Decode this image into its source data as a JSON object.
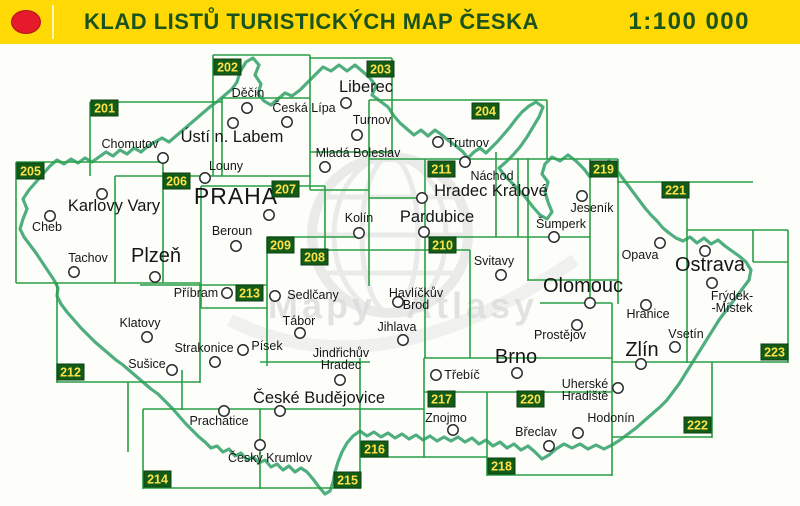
{
  "header": {
    "title": "KLAD LISTŮ TURISTICKÝCH MAP ČESKA",
    "scale": "1:100 000",
    "logo": "red-dot"
  },
  "colors": {
    "header_bg": "#ffd903",
    "header_text": "#1a531d",
    "logo_red": "#e51a2b",
    "logo_red_edge": "#b01020",
    "grid": "#28a044",
    "badge_bg": "#135c17",
    "badge_edge": "#0b3f10",
    "badge_text": "#ffe14a",
    "border": "#4fae7e",
    "city_text": "#161616",
    "marker_stroke": "#2d2d2d",
    "watermark": "#dcdcdc"
  },
  "map": {
    "watermark_words": [
      "Mapy",
      "Atlasy"
    ],
    "sheets": [
      {
        "num": "201",
        "x": 91,
        "y": 100
      },
      {
        "num": "202",
        "x": 214,
        "y": 59
      },
      {
        "num": "203",
        "x": 367,
        "y": 61
      },
      {
        "num": "204",
        "x": 472,
        "y": 103
      },
      {
        "num": "205",
        "x": 17,
        "y": 163
      },
      {
        "num": "206",
        "x": 163,
        "y": 173
      },
      {
        "num": "207",
        "x": 272,
        "y": 181
      },
      {
        "num": "208",
        "x": 301,
        "y": 249
      },
      {
        "num": "209",
        "x": 267,
        "y": 237
      },
      {
        "num": "210",
        "x": 429,
        "y": 237
      },
      {
        "num": "211",
        "x": 428,
        "y": 161
      },
      {
        "num": "212",
        "x": 57,
        "y": 364
      },
      {
        "num": "213",
        "x": 236,
        "y": 285
      },
      {
        "num": "214",
        "x": 144,
        "y": 471
      },
      {
        "num": "215",
        "x": 334,
        "y": 472
      },
      {
        "num": "216",
        "x": 361,
        "y": 441
      },
      {
        "num": "217",
        "x": 428,
        "y": 391
      },
      {
        "num": "218",
        "x": 488,
        "y": 458
      },
      {
        "num": "219",
        "x": 590,
        "y": 161
      },
      {
        "num": "220",
        "x": 517,
        "y": 391
      },
      {
        "num": "221",
        "x": 662,
        "y": 182
      },
      {
        "num": "222",
        "x": 684,
        "y": 417
      },
      {
        "num": "223",
        "x": 761,
        "y": 344
      }
    ],
    "cities": [
      {
        "n": [
          "Děčín"
        ],
        "cx": 247,
        "cy": 108,
        "lx": 248,
        "ly": 97,
        "s": "s"
      },
      {
        "n": [
          "Česká Lípa"
        ],
        "cx": 287,
        "cy": 122,
        "lx": 304,
        "ly": 112,
        "s": "s"
      },
      {
        "n": [
          "Liberec"
        ],
        "cx": 346,
        "cy": 103,
        "lx": 366,
        "ly": 92,
        "s": "m"
      },
      {
        "n": [
          "Turnov"
        ],
        "cx": 357,
        "cy": 135,
        "lx": 372,
        "ly": 124,
        "s": "s"
      },
      {
        "n": [
          "Mladá Boleslav"
        ],
        "cx": 325,
        "cy": 167,
        "lx": 358,
        "ly": 157,
        "s": "s"
      },
      {
        "n": [
          "Trutnov"
        ],
        "cx": 438,
        "cy": 142,
        "lx": 468,
        "ly": 147,
        "s": "s"
      },
      {
        "n": [
          "Náchod"
        ],
        "cx": 465,
        "cy": 162,
        "lx": 492,
        "ly": 180,
        "s": "s"
      },
      {
        "n": [
          "Hradec Králové"
        ],
        "cx": 422,
        "cy": 198,
        "lx": 491,
        "ly": 196,
        "s": "m"
      },
      {
        "n": [
          "Pardubice"
        ],
        "cx": 424,
        "cy": 232,
        "lx": 437,
        "ly": 222,
        "s": "m"
      },
      {
        "n": [
          "Jeseník"
        ],
        "cx": 582,
        "cy": 196,
        "lx": 592,
        "ly": 212,
        "s": "s"
      },
      {
        "n": [
          "Šumperk"
        ],
        "cx": 554,
        "cy": 237,
        "lx": 561,
        "ly": 228,
        "s": "s"
      },
      {
        "n": [
          "Svitavy"
        ],
        "cx": 501,
        "cy": 275,
        "lx": 494,
        "ly": 265,
        "s": "s"
      },
      {
        "n": [
          "Olomouc"
        ],
        "cx": 590,
        "cy": 303,
        "lx": 583,
        "ly": 292,
        "s": "l"
      },
      {
        "n": [
          "Prostějov"
        ],
        "cx": 577,
        "cy": 325,
        "lx": 560,
        "ly": 339,
        "s": "s"
      },
      {
        "n": [
          "Hranice"
        ],
        "cx": 646,
        "cy": 305,
        "lx": 648,
        "ly": 318,
        "s": "s"
      },
      {
        "n": [
          "Opava"
        ],
        "cx": 660,
        "cy": 243,
        "lx": 640,
        "ly": 259,
        "s": "s"
      },
      {
        "n": [
          "Ostrava"
        ],
        "cx": 705,
        "cy": 251,
        "lx": 710,
        "ly": 271,
        "s": "l"
      },
      {
        "n": [
          "Frýdek-",
          "-Místek"
        ],
        "cx": 712,
        "cy": 283,
        "lx": 732,
        "ly": 300,
        "s": "s"
      },
      {
        "n": [
          "Vsetín"
        ],
        "cx": 675,
        "cy": 347,
        "lx": 686,
        "ly": 338,
        "s": "s"
      },
      {
        "n": [
          "Zlín"
        ],
        "cx": 641,
        "cy": 364,
        "lx": 642,
        "ly": 356,
        "s": "l"
      },
      {
        "n": [
          "Uherské",
          "Hradiště"
        ],
        "cx": 618,
        "cy": 388,
        "lx": 585,
        "ly": 388,
        "s": "s"
      },
      {
        "n": [
          "Chomutov"
        ],
        "cx": 163,
        "cy": 158,
        "lx": 130,
        "ly": 148,
        "s": "s"
      },
      {
        "n": [
          "Ústí n. Labem"
        ],
        "cx": 233,
        "cy": 123,
        "lx": 232,
        "ly": 142,
        "s": "m"
      },
      {
        "n": [
          "Louny"
        ],
        "cx": 205,
        "cy": 178,
        "lx": 226,
        "ly": 170,
        "s": "s"
      },
      {
        "n": [
          "Karlovy Vary"
        ],
        "cx": 102,
        "cy": 194,
        "lx": 114,
        "ly": 211,
        "s": "m"
      },
      {
        "n": [
          "Cheb"
        ],
        "cx": 50,
        "cy": 216,
        "lx": 47,
        "ly": 231,
        "s": "s"
      },
      {
        "n": [
          "Tachov"
        ],
        "cx": 74,
        "cy": 272,
        "lx": 88,
        "ly": 262,
        "s": "s"
      },
      {
        "n": [
          "Plzeň"
        ],
        "cx": 155,
        "cy": 277,
        "lx": 156,
        "ly": 262,
        "s": "l"
      },
      {
        "n": [
          "PRAHA"
        ],
        "cx": 269,
        "cy": 215,
        "lx": 236,
        "ly": 204,
        "s": "xl"
      },
      {
        "n": [
          "Beroun"
        ],
        "cx": 236,
        "cy": 246,
        "lx": 232,
        "ly": 235,
        "s": "s"
      },
      {
        "n": [
          "Kolín"
        ],
        "cx": 359,
        "cy": 233,
        "lx": 359,
        "ly": 222,
        "s": "s"
      },
      {
        "n": [
          "Příbram"
        ],
        "cx": 227,
        "cy": 293,
        "lx": 196,
        "ly": 297,
        "s": "s"
      },
      {
        "n": [
          "Sedlčany"
        ],
        "cx": 275,
        "cy": 296,
        "lx": 313,
        "ly": 299,
        "s": "s"
      },
      {
        "n": [
          "Havlíčkův",
          "Brod"
        ],
        "cx": 398,
        "cy": 302,
        "lx": 416,
        "ly": 297,
        "s": "s"
      },
      {
        "n": [
          "Klatovy"
        ],
        "cx": 147,
        "cy": 337,
        "lx": 140,
        "ly": 327,
        "s": "s"
      },
      {
        "n": [
          "Strakonice"
        ],
        "cx": 215,
        "cy": 362,
        "lx": 204,
        "ly": 352,
        "s": "s"
      },
      {
        "n": [
          "Písek"
        ],
        "cx": 243,
        "cy": 350,
        "lx": 267,
        "ly": 350,
        "s": "s"
      },
      {
        "n": [
          "Sušice"
        ],
        "cx": 172,
        "cy": 370,
        "lx": 147,
        "ly": 368,
        "s": "s"
      },
      {
        "n": [
          "Tábor"
        ],
        "cx": 300,
        "cy": 333,
        "lx": 299,
        "ly": 325,
        "s": "s"
      },
      {
        "n": [
          "Jihlava"
        ],
        "cx": 403,
        "cy": 340,
        "lx": 397,
        "ly": 331,
        "s": "s"
      },
      {
        "n": [
          "Jindřichův",
          "Hradec"
        ],
        "cx": 340,
        "cy": 380,
        "lx": 341,
        "ly": 357,
        "s": "s"
      },
      {
        "n": [
          "Třebíč"
        ],
        "cx": 436,
        "cy": 375,
        "lx": 462,
        "ly": 379,
        "s": "s"
      },
      {
        "n": [
          "Brno"
        ],
        "cx": 517,
        "cy": 373,
        "lx": 516,
        "ly": 363,
        "s": "l"
      },
      {
        "n": [
          "České Budějovice"
        ],
        "cx": 280,
        "cy": 411,
        "lx": 319,
        "ly": 403,
        "s": "m"
      },
      {
        "n": [
          "Prachatice"
        ],
        "cx": 224,
        "cy": 411,
        "lx": 219,
        "ly": 425,
        "s": "s"
      },
      {
        "n": [
          "Český Krumlov"
        ],
        "cx": 260,
        "cy": 445,
        "lx": 270,
        "ly": 462,
        "s": "s"
      },
      {
        "n": [
          "Znojmo"
        ],
        "cx": 453,
        "cy": 430,
        "lx": 446,
        "ly": 422,
        "s": "s"
      },
      {
        "n": [
          "Břeclav"
        ],
        "cx": 549,
        "cy": 446,
        "lx": 536,
        "ly": 436,
        "s": "s"
      },
      {
        "n": [
          "Hodonín"
        ],
        "cx": 578,
        "cy": 433,
        "lx": 611,
        "ly": 422,
        "s": "s"
      }
    ],
    "grid_segments": [
      [
        213,
        55,
        213,
        176
      ],
      [
        310,
        55,
        310,
        190
      ],
      [
        392,
        58,
        392,
        152
      ],
      [
        90,
        102,
        90,
        176
      ],
      [
        222,
        98,
        222,
        176
      ],
      [
        369,
        100,
        369,
        286
      ],
      [
        547,
        100,
        547,
        159
      ],
      [
        16,
        162,
        16,
        283
      ],
      [
        163,
        162,
        163,
        283
      ],
      [
        115,
        176,
        115,
        283
      ],
      [
        201,
        186,
        201,
        308
      ],
      [
        325,
        186,
        325,
        252
      ],
      [
        267,
        237,
        267,
        366
      ],
      [
        425,
        159,
        425,
        358
      ],
      [
        470,
        250,
        470,
        358
      ],
      [
        496,
        152,
        496,
        237
      ],
      [
        518,
        158,
        518,
        237
      ],
      [
        528,
        158,
        528,
        281
      ],
      [
        590,
        159,
        590,
        304
      ],
      [
        618,
        159,
        618,
        304
      ],
      [
        687,
        182,
        687,
        363
      ],
      [
        753,
        230,
        753,
        262
      ],
      [
        788,
        230,
        788,
        363
      ],
      [
        612,
        303,
        612,
        476
      ],
      [
        712,
        362,
        712,
        438
      ],
      [
        487,
        392,
        487,
        476
      ],
      [
        424,
        358,
        424,
        458
      ],
      [
        360,
        358,
        360,
        489
      ],
      [
        260,
        409,
        260,
        489
      ],
      [
        143,
        409,
        143,
        489
      ],
      [
        128,
        382,
        128,
        452
      ],
      [
        57,
        283,
        57,
        383
      ],
      [
        200,
        283,
        200,
        383
      ],
      [
        182,
        370,
        182,
        410
      ],
      [
        213,
        55,
        310,
        55
      ],
      [
        309,
        58,
        392,
        58
      ],
      [
        90,
        102,
        222,
        102
      ],
      [
        222,
        98,
        310,
        98
      ],
      [
        369,
        100,
        547,
        100
      ],
      [
        310,
        152,
        392,
        152
      ],
      [
        16,
        162,
        163,
        162
      ],
      [
        369,
        159,
        618,
        159
      ],
      [
        115,
        176,
        310,
        176
      ],
      [
        201,
        186,
        325,
        186
      ],
      [
        310,
        190,
        369,
        190
      ],
      [
        369,
        198,
        425,
        198
      ],
      [
        617,
        182,
        753,
        182
      ],
      [
        687,
        230,
        788,
        230
      ],
      [
        753,
        262,
        788,
        262
      ],
      [
        16,
        283,
        200,
        283
      ],
      [
        267,
        237,
        360,
        237
      ],
      [
        425,
        237,
        590,
        237
      ],
      [
        301,
        250,
        470,
        250
      ],
      [
        140,
        285,
        267,
        285
      ],
      [
        201,
        308,
        267,
        308
      ],
      [
        528,
        280,
        618,
        280
      ],
      [
        540,
        303,
        612,
        303
      ],
      [
        424,
        358,
        612,
        358
      ],
      [
        612,
        362,
        788,
        362
      ],
      [
        424,
        392,
        612,
        392
      ],
      [
        360,
        457,
        487,
        457
      ],
      [
        487,
        475,
        612,
        475
      ],
      [
        612,
        437,
        712,
        437
      ],
      [
        57,
        382,
        200,
        382
      ],
      [
        143,
        409,
        424,
        409
      ],
      [
        260,
        362,
        370,
        362
      ],
      [
        143,
        488,
        360,
        488
      ]
    ],
    "border_path": "M20,229L23,219L27,209L23,199L29,190L36,182L43,174L50,166L57,160L64,164L71,159L78,163L85,158L92,162L99,157L106,152L113,156L120,150L127,154L134,148L141,152L148,146L155,142L162,138L169,142L176,136L183,130L190,124L197,118L204,112L211,106L218,101L225,95L232,89L237,82L240,72L246,62L253,58L259,65L255,75L261,84L258,94L264,101L271,105L278,99L285,93L292,96L300,90L308,82L316,74L323,67L331,71L339,65L347,71L355,65L362,71L369,77L376,86L372,95L380,101L388,107L394,116L400,123L407,129L414,135L421,130L428,136L435,130L442,135L449,141L456,146L463,152L468,158L474,152L480,148L486,153L492,147L498,141L504,134L510,127L516,119L522,112L529,106L536,102L543,107L539,117L533,127L527,137L520,147L513,155L506,162L499,168L505,176L512,183L519,190L526,198L533,207L540,215L547,219L552,212L548,202L545,192L548,182L542,174L545,164L552,157L560,161L568,155L576,161L584,169L590,177L596,172L602,165L609,161L615,168L621,176L627,184L633,192L639,200L645,208L651,215L657,221L663,228L669,233L676,238L683,241L690,237L697,243L704,238L711,244L718,240L725,246L732,251L739,256L746,262L751,270L749,280L743,288L737,296L731,304L725,312L719,320L714,328L709,336L704,344L699,352L694,360L689,368L684,376L679,384L673,392L667,400L660,407L652,414L644,421L636,428L628,434L620,440L612,445L604,449L596,445L588,449L580,444L572,448L564,444L556,449L549,455L542,459L535,452L528,446L521,450L514,444L507,448L500,442L493,446L486,440L479,444L472,438L465,442L458,437L451,441L444,437L437,441L430,436L423,440L416,435L409,439L402,434L395,438L388,433L381,437L374,432L367,436L360,431L353,436L347,443L342,452L338,462L335,472L333,482L330,491L325,494L319,487L313,479L307,472L301,468L295,472L289,466L283,470L277,464L271,467L265,460L259,463L253,457L247,460L241,453L235,456L229,449L223,452L217,446L211,448L205,442L199,437L193,431L186,424L179,416L172,408L165,401L158,394L151,389L144,383L137,377L130,371L123,365L116,360L109,354L102,348L95,342L88,335L81,328L74,320L67,312L61,304L57,296L58,288L54,280L48,271L42,262L36,253L30,245L24,237Z"
  }
}
